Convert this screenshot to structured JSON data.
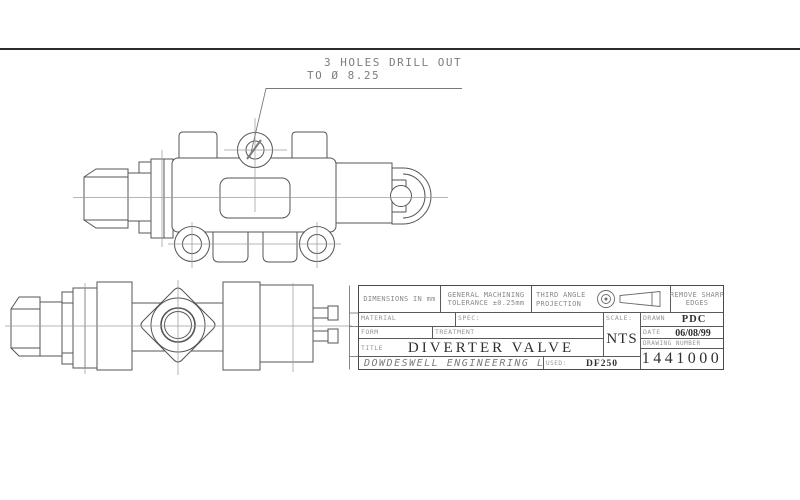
{
  "annotation": {
    "line1": "3 HOLES DRILL OUT",
    "line2": "TO Ø 8.25"
  },
  "title_block": {
    "dimensions_note": "DIMENSIONS IN mm",
    "tolerance_line1": "GENERAL MACHINING",
    "tolerance_line2": "TOLERANCE ±0.25mm",
    "projection_line1": "THIRD ANGLE",
    "projection_line2": "PROJECTION",
    "edges_line1": "REMOVE SHARP",
    "edges_line2": "EDGES",
    "material_label": "MATERIAL",
    "spec_label": "SPEC:",
    "form_label": "FORM",
    "treatment_label": "TREATMENT",
    "title_label": "TITLE",
    "title_value": "DIVERTER VALVE",
    "scale_label": "SCALE:",
    "scale_value": "NTS",
    "drawn_label": "DRAWN",
    "drawn_value": "PDC",
    "date_label": "DATE",
    "date_value": "06/08/99",
    "drawing_number_label": "DRAWING NUMBER",
    "drawing_number_value": "1441000",
    "company": "DOWDESWELL ENGINEERING LTD",
    "used_label": "USED:",
    "used_value": "DF250"
  },
  "colors": {
    "line": "#555555",
    "centerline": "#9d9d9d",
    "annotation_text": "#7d7d7d",
    "background": "#ffffff"
  },
  "icons": {
    "third_angle_symbol": "third-angle-projection-symbol"
  }
}
